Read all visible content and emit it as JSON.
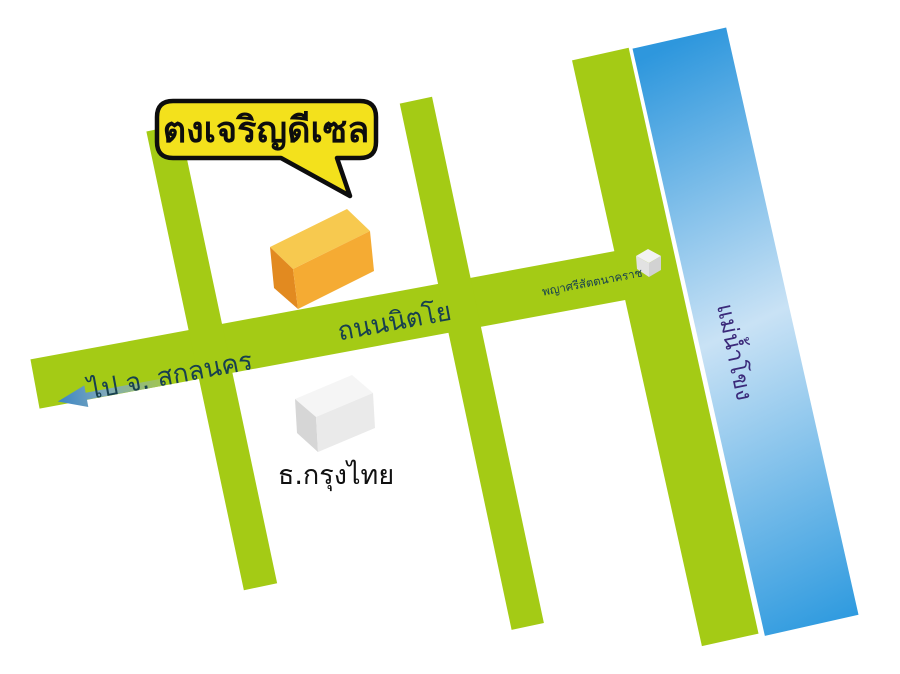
{
  "map": {
    "callout": {
      "label": "ตงเจริญดีเซล"
    },
    "roads": {
      "main_road_label": "ถนนนิตโย",
      "direction_label": "ไป จ. สกลนคร"
    },
    "landmarks": {
      "naga_label": "พญาศรีสัตตนาคราช",
      "bank_label": "ธ.กรุงไทย",
      "river_label": "แม่น้ำโขง"
    },
    "colors": {
      "road_green": "#A4CB15",
      "river_blue_top": "#2E97DD",
      "river_blue_light": "#C9E2F5",
      "river_blue_bottom": "#2E9ADF",
      "callout_yellow": "#F3E11C",
      "callout_border": "#0D0D0D",
      "shop_top": "#F7C94F",
      "shop_front": "#F5AB33",
      "shop_side": "#E28A20",
      "bank_top": "#F5F5F5",
      "bank_front": "#EAEAEA",
      "bank_side": "#D6D6D6",
      "cube_top": "#F2F2F2",
      "cube_front": "#E2E2E2",
      "cube_side": "#D2D2D2",
      "road_text": "#17404F",
      "river_text": "#3B2A7A",
      "bank_text": "#111111",
      "arrow_tip_blue": "#3A85C5",
      "arrow_mid": "#7FA9BC",
      "arrow_tail_green": "#A2C64F"
    }
  }
}
